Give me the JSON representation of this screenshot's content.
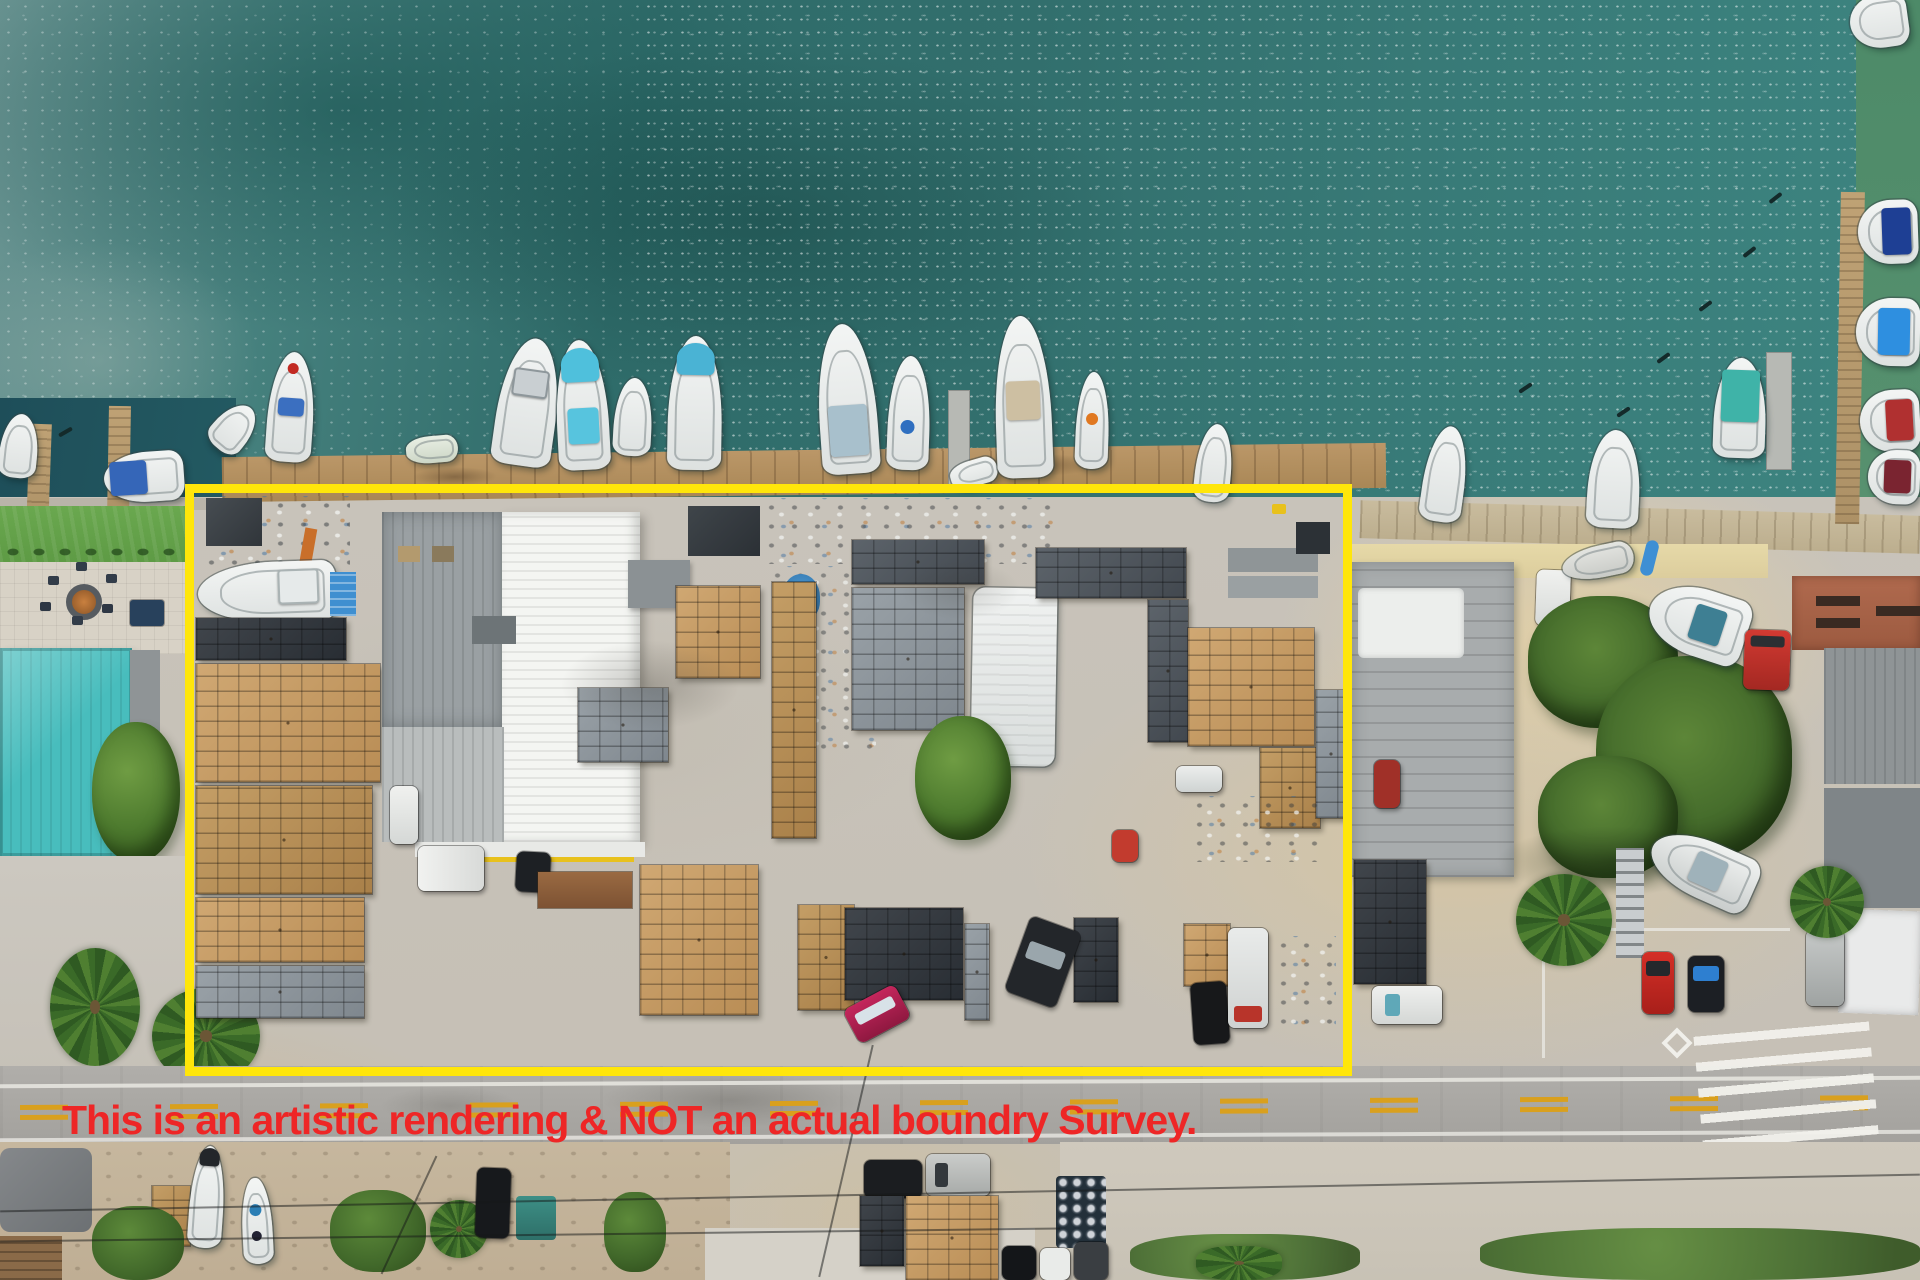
{
  "image_type": "aerial-drone-photograph",
  "annotation": {
    "disclaimer_text": "This is an artistic rendering & NOT an actual boundry Survey.",
    "disclaimer_color": "#ee2626",
    "boundary_box_color": "#ffe60a"
  },
  "palette": {
    "water_teal": "#2f6c6a",
    "water_shallow": "#6d9694",
    "green_water": "#4d8a68",
    "canal_water": "#1e4e59",
    "dock_wood": "#b3905f",
    "teal_roof": "#48bdbd",
    "warehouse_roof_white": "#f4f5f2",
    "warehouse_roof_gray": "#9aa0a3",
    "trap_stack_tan": "#c49f68",
    "trap_stack_gray": "#8e959c",
    "road_asphalt": "#a9a7a3",
    "lane_marking_yellow": "#d9a01e",
    "sand": "#d9c9a4"
  },
  "scene_inventory": {
    "boundary_highlight": "yellow rectangle outlining the waterfront commercial yard parcel",
    "features": [
      "marina dock with moored fishing boats",
      "lobster trap stacks in tan and gray",
      "large white metal warehouse roof",
      "teal hip-roof building with fire-pit patio and lawn",
      "palm trees and large shade trees",
      "road with double yellow dashed center line and crosswalk",
      "parked cars, pickup trucks and a travel trailer",
      "boats stored on land and a red forklift",
      "barrel cluster and pallet stacks in the lower lot"
    ]
  }
}
